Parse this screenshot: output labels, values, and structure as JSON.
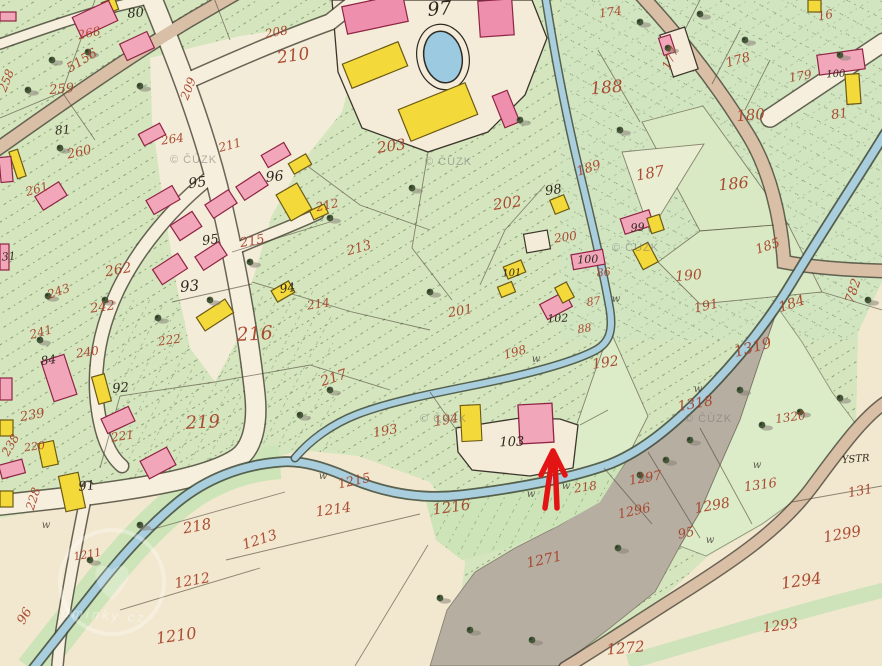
{
  "map_type": "historical-cadastral-map",
  "annotation_arrow": {
    "color": "#e21414",
    "tip": {
      "x": 553,
      "y": 451
    }
  },
  "watermark": {
    "text": "© ČÚZK",
    "positions": [
      {
        "x": 170,
        "y": 163
      },
      {
        "x": 425,
        "y": 165
      },
      {
        "x": 612,
        "y": 251
      },
      {
        "x": 685,
        "y": 422
      },
      {
        "x": 420,
        "y": 422
      }
    ]
  },
  "logo_watermark": {
    "fragment_text": "dminky cz",
    "cx": 112,
    "cy": 582
  },
  "palette": {
    "parchment": "#f2e8cf",
    "meadow_green": "#d5e6bf",
    "pale_green": "#dcebc8",
    "grey_pasture": "#b7aea2",
    "stream_blue": "#a9cfdf",
    "road_tan": "#d8bfa6",
    "building_pink": "#f2a6ba",
    "building_yellow": "#f4d93b",
    "farm_pink": "#ee8fad",
    "red_number": "#a8432a",
    "black_number": "#2e2920",
    "arrow_red": "#e21414"
  },
  "labels": {
    "red": [
      {
        "t": "268",
        "x": 90,
        "y": 37,
        "s": 12,
        "r": -12
      },
      {
        "t": "208",
        "x": 277,
        "y": 36,
        "s": 12,
        "r": -10
      },
      {
        "t": "5156",
        "x": 84,
        "y": 64,
        "s": 13,
        "r": -32
      },
      {
        "t": "258",
        "x": 10,
        "y": 82,
        "s": 12,
        "r": -68
      },
      {
        "t": "259",
        "x": 62,
        "y": 93,
        "s": 13,
        "r": -5
      },
      {
        "t": "260",
        "x": 80,
        "y": 156,
        "s": 13,
        "r": -12
      },
      {
        "t": "261",
        "x": 38,
        "y": 193,
        "s": 12,
        "r": -15
      },
      {
        "t": "264",
        "x": 173,
        "y": 143,
        "s": 12,
        "r": -8
      },
      {
        "t": "211",
        "x": 231,
        "y": 149,
        "s": 12,
        "r": -15
      },
      {
        "t": "209",
        "x": 192,
        "y": 90,
        "s": 12,
        "r": -68
      },
      {
        "t": "210",
        "x": 294,
        "y": 61,
        "s": 17,
        "r": -8
      },
      {
        "t": "203",
        "x": 392,
        "y": 151,
        "s": 15,
        "r": -8
      },
      {
        "t": "202",
        "x": 508,
        "y": 208,
        "s": 15,
        "r": -8
      },
      {
        "t": "200",
        "x": 566,
        "y": 241,
        "s": 12,
        "r": -8
      },
      {
        "t": "201",
        "x": 461,
        "y": 315,
        "s": 13,
        "r": -10
      },
      {
        "t": "189",
        "x": 590,
        "y": 172,
        "s": 13,
        "r": -18
      },
      {
        "t": "187",
        "x": 651,
        "y": 178,
        "s": 15,
        "r": -10
      },
      {
        "t": "188",
        "x": 607,
        "y": 93,
        "s": 17,
        "r": -5
      },
      {
        "t": "174",
        "x": 611,
        "y": 16,
        "s": 12,
        "r": -8
      },
      {
        "t": "177",
        "x": 674,
        "y": 60,
        "s": 12,
        "r": -65
      },
      {
        "t": "178",
        "x": 739,
        "y": 64,
        "s": 13,
        "r": -15
      },
      {
        "t": "179",
        "x": 801,
        "y": 80,
        "s": 12,
        "r": -10
      },
      {
        "t": "16",
        "x": 826,
        "y": 19,
        "s": 12,
        "r": -10
      },
      {
        "t": "180",
        "x": 751,
        "y": 120,
        "s": 15,
        "r": -5
      },
      {
        "t": "186",
        "x": 734,
        "y": 189,
        "s": 16,
        "r": -5
      },
      {
        "t": "185",
        "x": 769,
        "y": 250,
        "s": 13,
        "r": -18
      },
      {
        "t": "190",
        "x": 689,
        "y": 280,
        "s": 14,
        "r": -5
      },
      {
        "t": "191",
        "x": 707,
        "y": 310,
        "s": 13,
        "r": -12
      },
      {
        "t": "184",
        "x": 793,
        "y": 308,
        "s": 14,
        "r": -18
      },
      {
        "t": "782",
        "x": 857,
        "y": 292,
        "s": 13,
        "r": -72
      },
      {
        "t": "86",
        "x": 604,
        "y": 276,
        "s": 11,
        "r": -5
      },
      {
        "t": "87",
        "x": 594,
        "y": 305,
        "s": 11,
        "r": -8
      },
      {
        "t": "88",
        "x": 585,
        "y": 332,
        "s": 11,
        "r": -8
      },
      {
        "t": "198",
        "x": 516,
        "y": 356,
        "s": 12,
        "r": -15
      },
      {
        "t": "192",
        "x": 606,
        "y": 367,
        "s": 14,
        "r": -8
      },
      {
        "t": "193",
        "x": 386,
        "y": 435,
        "s": 13,
        "r": -10
      },
      {
        "t": "194",
        "x": 447,
        "y": 424,
        "s": 13,
        "r": -10
      },
      {
        "t": "213",
        "x": 360,
        "y": 252,
        "s": 13,
        "r": -15
      },
      {
        "t": "215",
        "x": 253,
        "y": 245,
        "s": 13,
        "r": -10
      },
      {
        "t": "212",
        "x": 328,
        "y": 209,
        "s": 12,
        "r": -12
      },
      {
        "t": "214",
        "x": 319,
        "y": 308,
        "s": 12,
        "r": -8
      },
      {
        "t": "216",
        "x": 255,
        "y": 340,
        "s": 19,
        "r": -3
      },
      {
        "t": "217",
        "x": 335,
        "y": 382,
        "s": 14,
        "r": -18
      },
      {
        "t": "222",
        "x": 170,
        "y": 344,
        "s": 12,
        "r": -8
      },
      {
        "t": "219",
        "x": 203,
        "y": 428,
        "s": 18,
        "r": -3
      },
      {
        "t": "242",
        "x": 103,
        "y": 311,
        "s": 13,
        "r": -8
      },
      {
        "t": "243",
        "x": 60,
        "y": 295,
        "s": 12,
        "r": -20
      },
      {
        "t": "241",
        "x": 42,
        "y": 336,
        "s": 12,
        "r": -15
      },
      {
        "t": "240",
        "x": 88,
        "y": 356,
        "s": 12,
        "r": -8
      },
      {
        "t": "239",
        "x": 33,
        "y": 419,
        "s": 13,
        "r": -10
      },
      {
        "t": "238",
        "x": 14,
        "y": 447,
        "s": 12,
        "r": -60
      },
      {
        "t": "228",
        "x": 37,
        "y": 500,
        "s": 12,
        "r": -72
      },
      {
        "t": "220",
        "x": 35,
        "y": 450,
        "s": 11,
        "r": -8
      },
      {
        "t": "221",
        "x": 123,
        "y": 440,
        "s": 12,
        "r": -8
      },
      {
        "t": "262",
        "x": 119,
        "y": 274,
        "s": 14,
        "r": -10
      },
      {
        "t": "218",
        "x": 198,
        "y": 531,
        "s": 15,
        "r": -10
      },
      {
        "t": "218",
        "x": 586,
        "y": 491,
        "s": 12,
        "r": -8
      },
      {
        "t": "1215",
        "x": 355,
        "y": 485,
        "s": 13,
        "r": -12
      },
      {
        "t": "1214",
        "x": 334,
        "y": 514,
        "s": 14,
        "r": -8
      },
      {
        "t": "1216",
        "x": 452,
        "y": 512,
        "s": 15,
        "r": -8
      },
      {
        "t": "1213",
        "x": 261,
        "y": 544,
        "s": 14,
        "r": -18
      },
      {
        "t": "1212",
        "x": 193,
        "y": 585,
        "s": 14,
        "r": -10
      },
      {
        "t": "1211",
        "x": 88,
        "y": 558,
        "s": 11,
        "r": -10
      },
      {
        "t": "1210",
        "x": 177,
        "y": 641,
        "s": 16,
        "r": -8
      },
      {
        "t": "96",
        "x": 28,
        "y": 618,
        "s": 13,
        "r": -60
      },
      {
        "t": "1271",
        "x": 545,
        "y": 564,
        "s": 14,
        "r": -12
      },
      {
        "t": "1272",
        "x": 626,
        "y": 653,
        "s": 15,
        "r": -5
      },
      {
        "t": "1293",
        "x": 781,
        "y": 630,
        "s": 14,
        "r": -8
      },
      {
        "t": "1294",
        "x": 802,
        "y": 586,
        "s": 16,
        "r": -8
      },
      {
        "t": "1299",
        "x": 843,
        "y": 539,
        "s": 15,
        "r": -10
      },
      {
        "t": "1296",
        "x": 635,
        "y": 515,
        "s": 13,
        "r": -12
      },
      {
        "t": "1297",
        "x": 646,
        "y": 482,
        "s": 13,
        "r": -10
      },
      {
        "t": "1298",
        "x": 713,
        "y": 510,
        "s": 14,
        "r": -10
      },
      {
        "t": "95",
        "x": 687,
        "y": 537,
        "s": 13,
        "r": -12
      },
      {
        "t": "1316",
        "x": 761,
        "y": 489,
        "s": 13,
        "r": -8
      },
      {
        "t": "131",
        "x": 861,
        "y": 495,
        "s": 13,
        "r": -10
      },
      {
        "t": "1320",
        "x": 791,
        "y": 421,
        "s": 12,
        "r": -8
      },
      {
        "t": "1318",
        "x": 696,
        "y": 408,
        "s": 14,
        "r": -10
      },
      {
        "t": "1319",
        "x": 754,
        "y": 352,
        "s": 15,
        "r": -15
      },
      {
        "t": "81",
        "x": 840,
        "y": 118,
        "s": 13,
        "r": -8
      }
    ],
    "black": [
      {
        "t": "80",
        "x": 136,
        "y": 17,
        "s": 13,
        "r": -5
      },
      {
        "t": "81",
        "x": 63,
        "y": 134,
        "s": 12,
        "r": -5
      },
      {
        "t": "31",
        "x": 9,
        "y": 260,
        "s": 11,
        "r": -5
      },
      {
        "t": "97",
        "x": 440,
        "y": 15,
        "s": 19,
        "r": -5
      },
      {
        "t": "95",
        "x": 198,
        "y": 187,
        "s": 14,
        "r": -8
      },
      {
        "t": "95",
        "x": 211,
        "y": 244,
        "s": 13,
        "r": -8
      },
      {
        "t": "96",
        "x": 275,
        "y": 181,
        "s": 14,
        "r": -5
      },
      {
        "t": "93",
        "x": 190,
        "y": 291,
        "s": 15,
        "r": -5
      },
      {
        "t": "94",
        "x": 288,
        "y": 292,
        "s": 12,
        "r": -8
      },
      {
        "t": "92",
        "x": 121,
        "y": 392,
        "s": 13,
        "r": -5
      },
      {
        "t": "84",
        "x": 49,
        "y": 364,
        "s": 12,
        "r": -8
      },
      {
        "t": "91",
        "x": 87,
        "y": 490,
        "s": 13,
        "r": -5
      },
      {
        "t": "98",
        "x": 554,
        "y": 194,
        "s": 13,
        "r": -8
      },
      {
        "t": "99",
        "x": 638,
        "y": 231,
        "s": 11,
        "r": -5
      },
      {
        "t": "100",
        "x": 588,
        "y": 263,
        "s": 11,
        "r": -3
      },
      {
        "t": "101",
        "x": 512,
        "y": 276,
        "s": 10,
        "r": -3
      },
      {
        "t": "102",
        "x": 558,
        "y": 322,
        "s": 11,
        "r": -3
      },
      {
        "t": "103",
        "x": 512,
        "y": 446,
        "s": 13,
        "r": -2
      },
      {
        "t": "100",
        "x": 836,
        "y": 77,
        "s": 10,
        "r": -3
      },
      {
        "t": "YSTR",
        "x": 856,
        "y": 462,
        "s": 10,
        "r": -5
      }
    ],
    "meadow_marks": [
      {
        "x": 536,
        "y": 362
      },
      {
        "x": 616,
        "y": 302
      },
      {
        "x": 566,
        "y": 489
      },
      {
        "x": 757,
        "y": 468
      },
      {
        "x": 710,
        "y": 543
      },
      {
        "x": 46,
        "y": 528
      },
      {
        "x": 698,
        "y": 392
      },
      {
        "x": 323,
        "y": 479
      },
      {
        "x": 531,
        "y": 497
      }
    ]
  }
}
